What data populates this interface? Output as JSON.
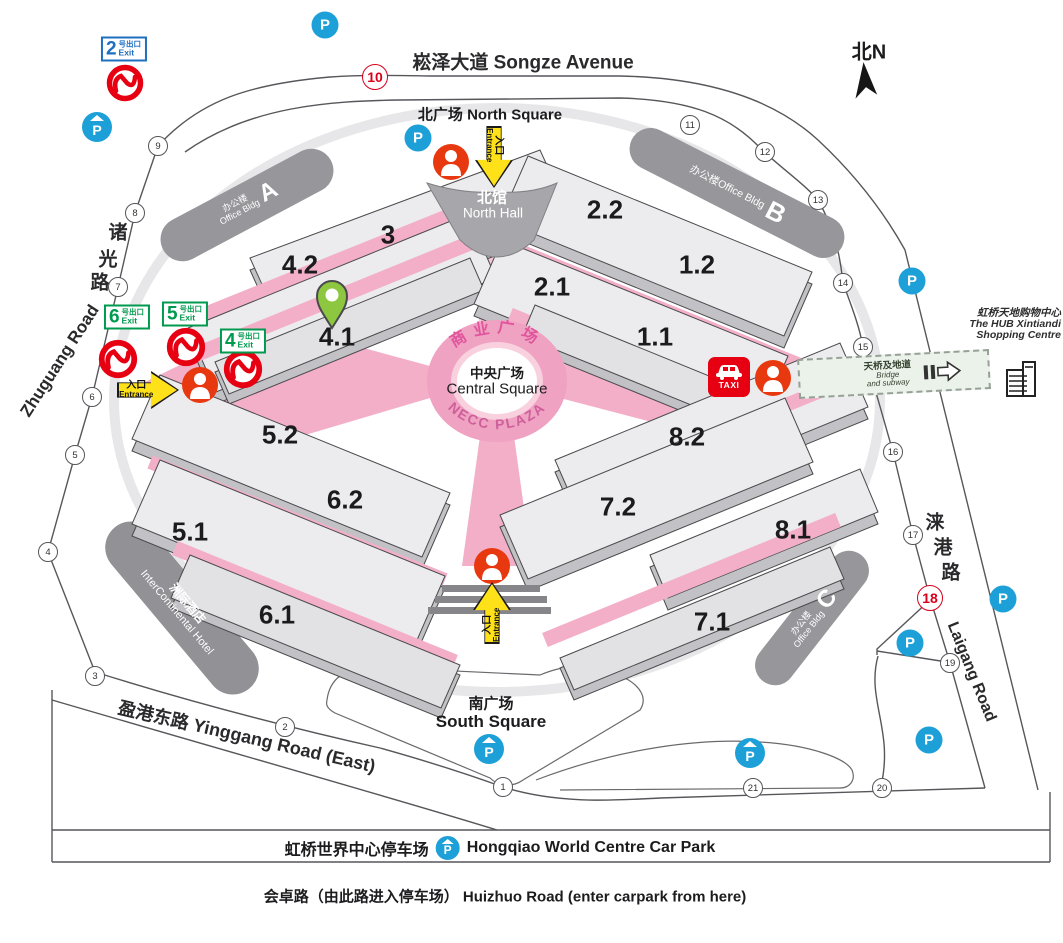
{
  "roads": {
    "songze": "崧泽大道 Songze Avenue",
    "zhuguang_cn": [
      "诸",
      "光",
      "路"
    ],
    "zhuguang_en": "Zhuguang Road",
    "laigang_cn": [
      "涞",
      "港",
      "路"
    ],
    "laigang_en": "Laigang Road",
    "yinggang": "盈港东路 Yinggang Road (East)",
    "huizhuo": "会卓路（由此路进入停车场）  Huizhuo Road (enter carpark from here)"
  },
  "squares": {
    "north": "北广场 North Square",
    "south_cn": "南广场",
    "south_en": "South Square",
    "north_hall_cn": "北馆",
    "north_hall_en": "North Hall"
  },
  "plaza": {
    "arc_top": "商业广场",
    "arc_bottom": "NECC PLAZA",
    "center_cn": "中央广场",
    "center_en": "Central Square"
  },
  "halls": {
    "h3": "3",
    "h42": "4.2",
    "h41": "4.1",
    "h22": "2.2",
    "h21": "2.1",
    "h12": "1.2",
    "h11": "1.1",
    "h52": "5.2",
    "h62": "6.2",
    "h51": "5.1",
    "h61": "6.1",
    "h82": "8.2",
    "h72": "7.2",
    "h81": "8.1",
    "h71": "7.1"
  },
  "buildings": {
    "office_cn": "办公楼",
    "office_en": "Office Bldg",
    "a": "A",
    "b": "B",
    "c": "C",
    "hotel_cn": "洲际酒店",
    "hotel_en": "InterContinental Hotel"
  },
  "exits": {
    "e2": "2",
    "e4": "4",
    "e5": "5",
    "e6": "6",
    "suffix_cn": "号出口",
    "suffix_en": "Exit"
  },
  "entrance": {
    "cn": "入口",
    "en": "Entrance"
  },
  "bridge": {
    "cn": "天桥及地道",
    "en1": "Bridge",
    "en2": "and subway"
  },
  "hub": {
    "line1": "虹桥天地购物中心",
    "line2": "The HUB Xintiandi",
    "line3": "Shopping Centre"
  },
  "carpark": {
    "cn": "虹桥世界中心停车场",
    "en": "Hongqiao World Centre Car Park"
  },
  "compass": "北N",
  "taxi_label": "TAXI",
  "parking_letter": "P",
  "gates": [
    "1",
    "2",
    "3",
    "4",
    "5",
    "6",
    "7",
    "8",
    "9",
    "10",
    "11",
    "12",
    "13",
    "14",
    "15",
    "16",
    "17",
    "18",
    "19",
    "20",
    "21"
  ],
  "colors": {
    "plaza_pink": "#efa2c1",
    "corridor_pink": "#f3aec8",
    "metro_red": "#e60012",
    "parking_blue": "#1da0d8",
    "exit_green": "#009a4e",
    "exit_blue": "#1e6fc0",
    "entrance_yellow": "#ffe11a",
    "pin_green": "#8dc63f",
    "person_red": "#e8380f"
  }
}
